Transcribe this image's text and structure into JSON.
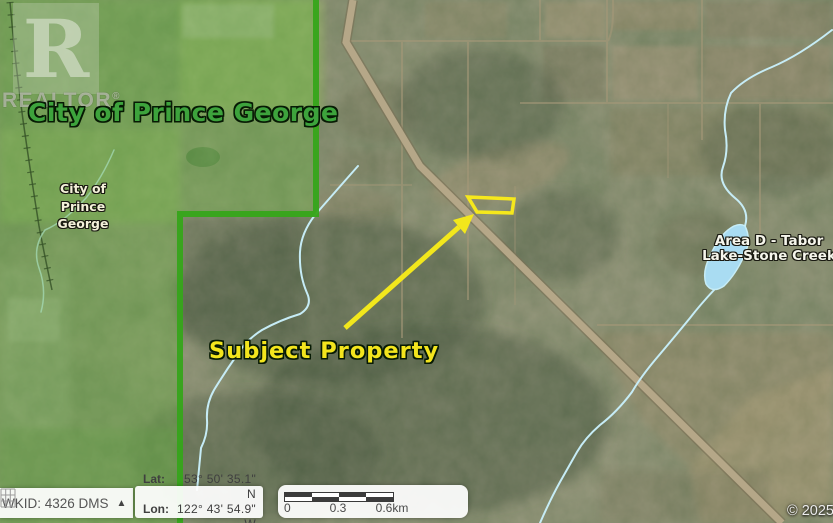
{
  "watermark": {
    "logo_letter": "R",
    "brand": "REALTOR",
    "registered_mark": "®"
  },
  "annotations": {
    "city_label_large": "City of Prince George",
    "city_label_small_lines": [
      "City of",
      "Prince",
      "George"
    ],
    "area_label_lines": [
      "Area D - Tabor",
      "Lake-Stone Creek"
    ],
    "subject_property_label": "Subject Property",
    "copyright": "© 2025"
  },
  "status_bar": {
    "projection": {
      "label": "WKID: 4326 DMS",
      "dropdown_arrow": "▲"
    },
    "coordinates": {
      "lat_label": "Lat:",
      "lat_value": "53° 50' 35.1\" N",
      "lon_label": "Lon:",
      "lon_value": "122° 43' 54.9\" W"
    },
    "scale_bar": {
      "start": "0",
      "middle": "0.3",
      "end": "0.6km"
    }
  },
  "colors": {
    "city_boundary_green": "#36a51a",
    "city_label_green": "#3da33c",
    "subject_marker_yellow": "#f6e81c",
    "creek_blue": "#c6ecf6",
    "lake_blue": "#a9dcf2",
    "highway_tan": "#b5a788"
  }
}
